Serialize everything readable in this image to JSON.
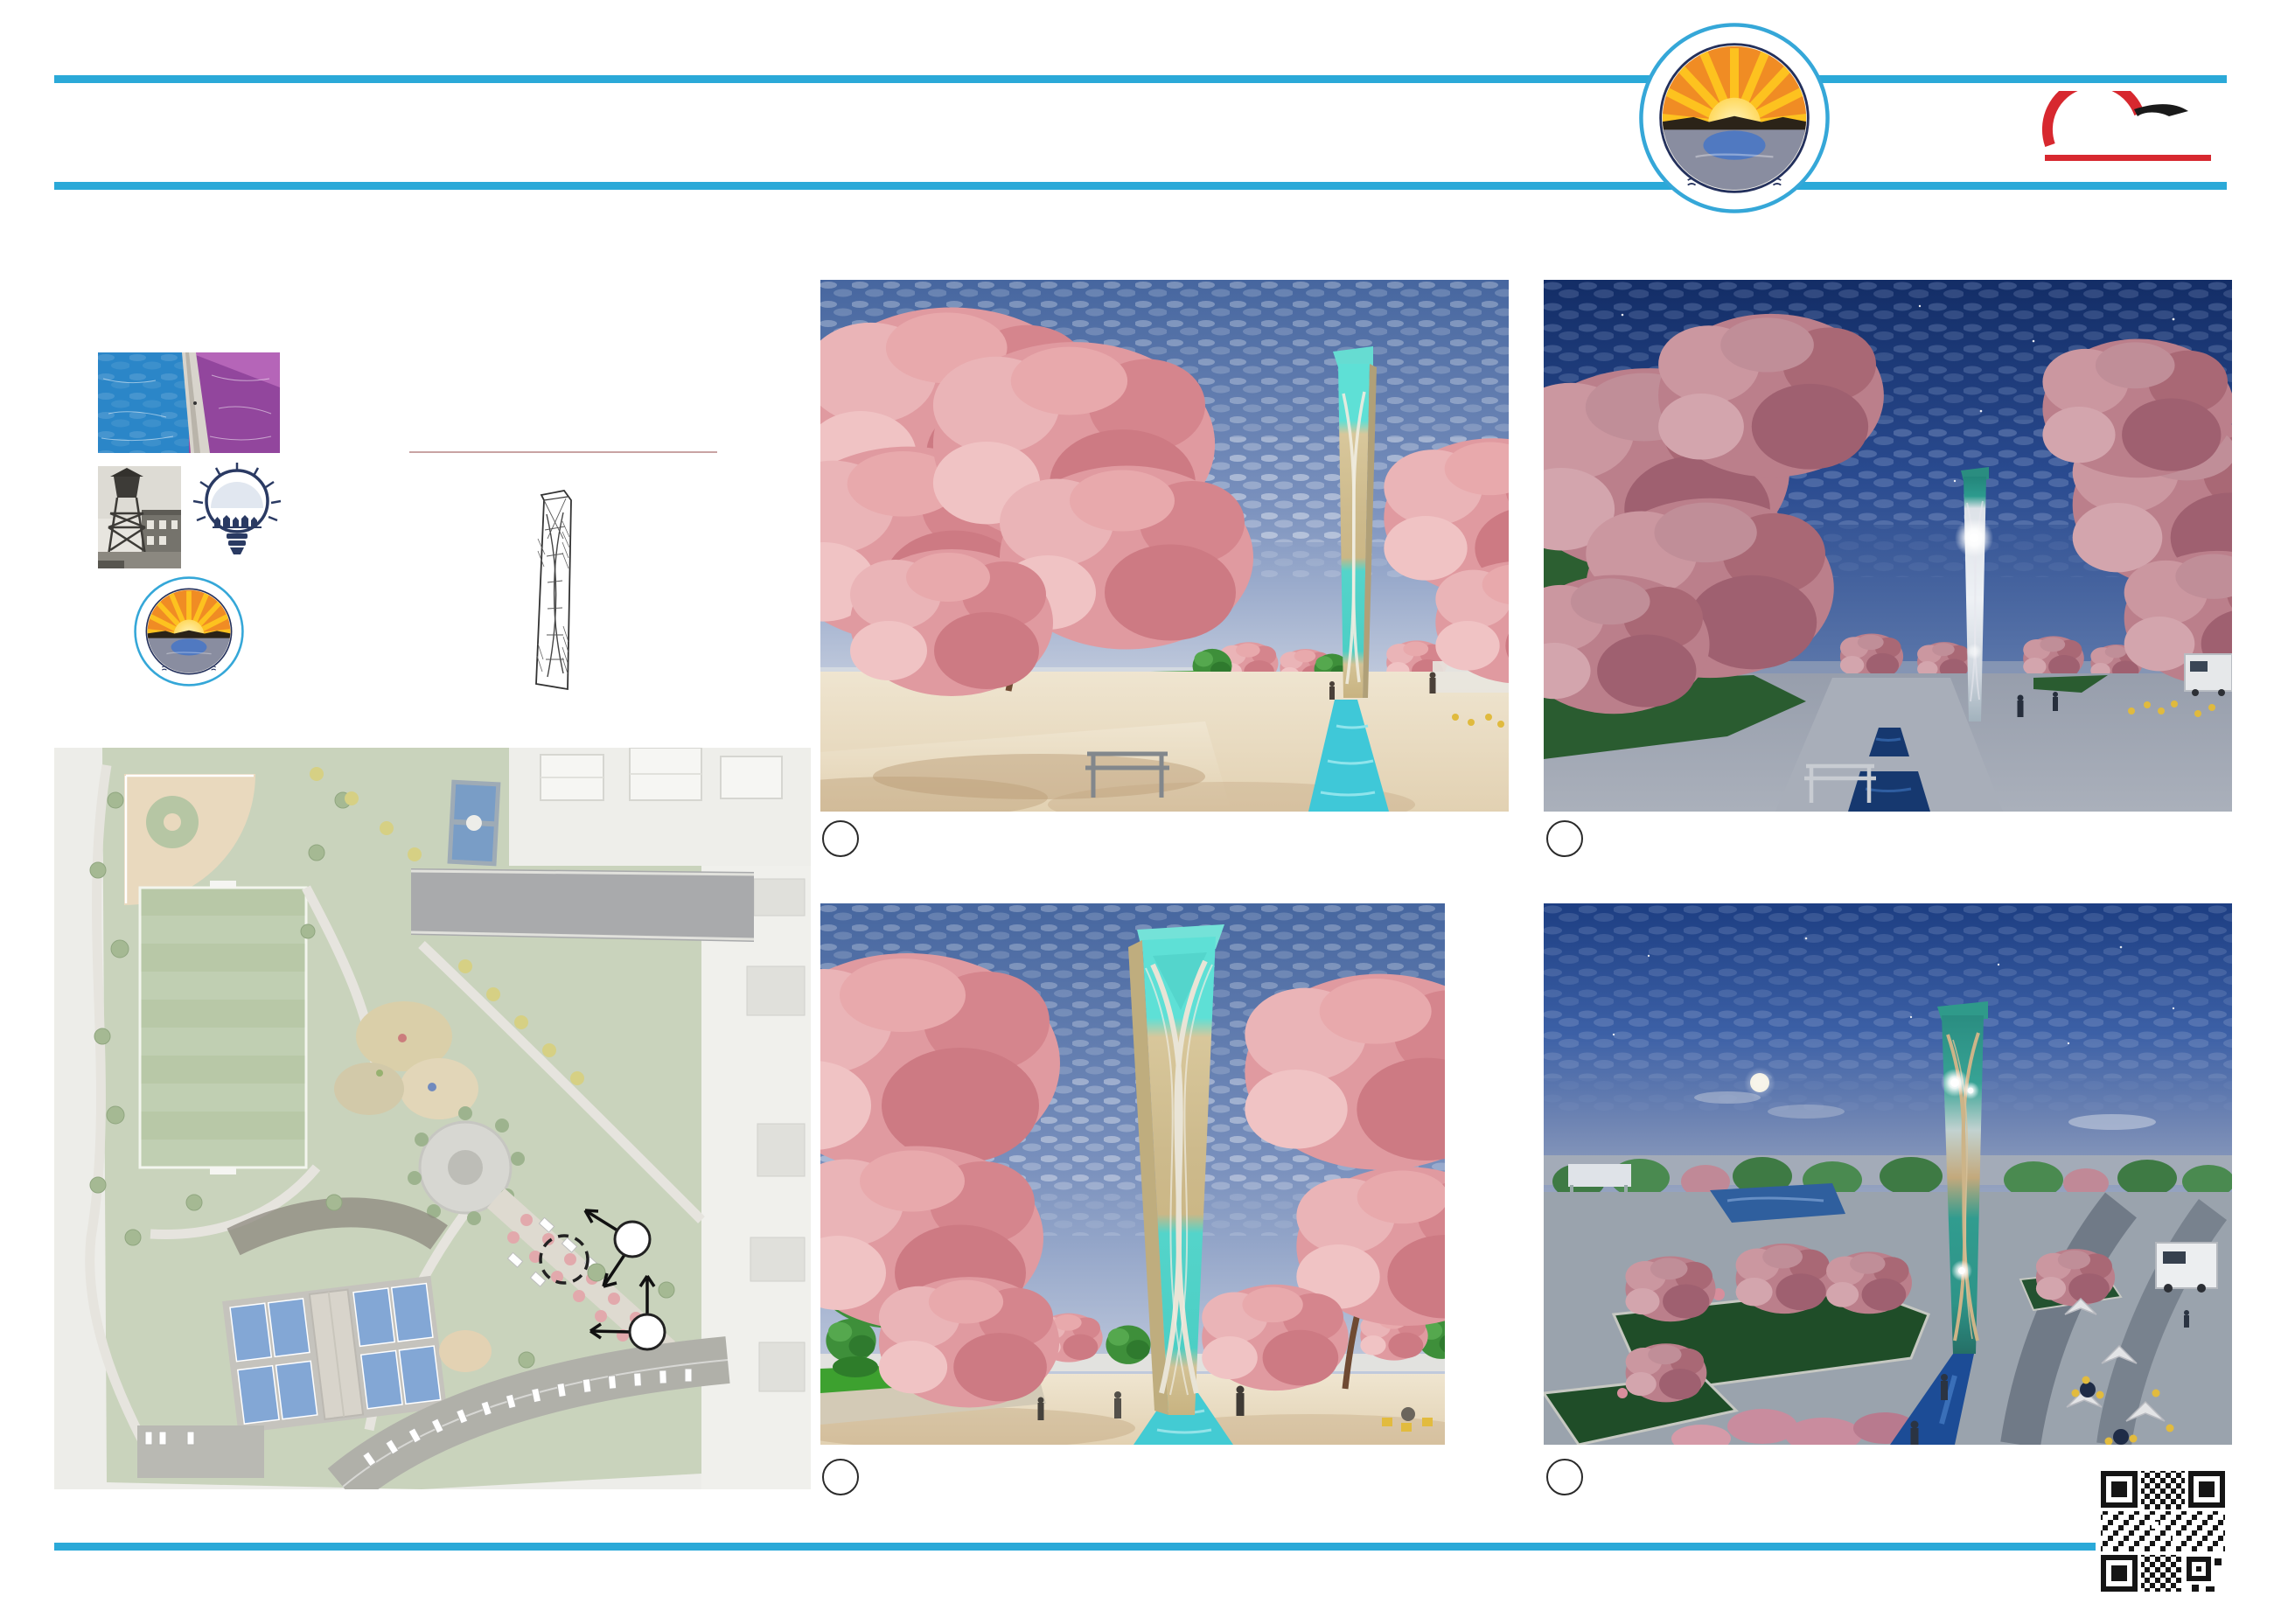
{
  "header": {
    "title": "FOCAL FEATURE - COLOR",
    "subtitle": "Hatch Park - Public Open House",
    "accent_color": "#2BA9D8"
  },
  "estimated_cost": "ESTIMATED COST: $900,000",
  "tower_design": {
    "label": "TOWER DESIGN:",
    "value": "COLOR TOWER= CONCEPT 7",
    "subheading": "PAST TO FUTURE INSPIRATION",
    "blurb_line1": "BLENDING INDUSTRIAL HISTORY AND IMPORTANCE OF WATER",
    "blurb_line2": "REPRESENTATIVE OF A BRIGHT COLORFUL FUTURE"
  },
  "logos": {
    "city_seal": {
      "arc_text": "CITY OF NORTH SALT LAKE",
      "bottom_text": "UTAH"
    },
    "gbd": {
      "monogram": "G.B:D",
      "name": "G. BROWN : DESIGN INC",
      "tagline": "SITE AND LANDSCAPE ARCHITECTS"
    },
    "hogan": {
      "name": "HOGAN",
      "tagline": "& ASSOCIATES CONSTRUCTION"
    },
    "nsl_bulb": {
      "script": "Imagine",
      "main": "NSL",
      "year": "2046"
    }
  },
  "renderings": [
    {
      "number": "1",
      "label": "DAY"
    },
    {
      "number": "1",
      "label": "NIGHT"
    },
    {
      "number": "1",
      "label": "DAY"
    },
    {
      "number": "2",
      "label": "NIGHT"
    }
  ],
  "key_map": {
    "label": "KEY MAP",
    "markers": [
      {
        "number": "1"
      },
      {
        "number": "2"
      }
    ]
  },
  "qr": {
    "line1": "SCAN QR CODE TO",
    "line2": "LEAVE COMMENTS",
    "line3": "ON CITY'S WEBSITE",
    "brand": "bitly"
  },
  "colors": {
    "tower_teal": "#57D6CC",
    "tower_tan": "#CDBB8D",
    "blossom_pink": "#E09AA0"
  }
}
